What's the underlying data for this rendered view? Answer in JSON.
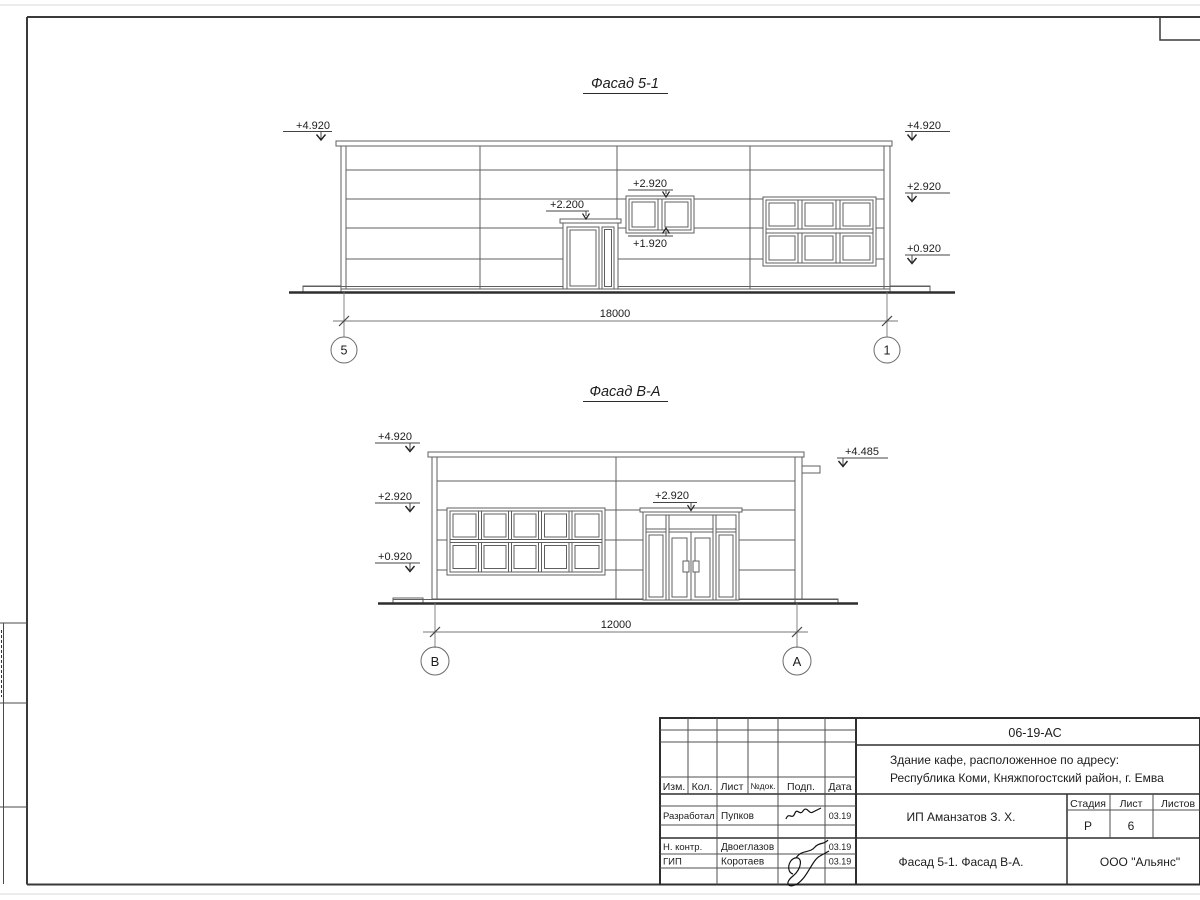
{
  "sheet": {
    "code_box": "06-19-АС"
  },
  "facade1": {
    "title": "Фасад 5-1",
    "marks": {
      "left_top": "+4.920",
      "right_top": "+4.920",
      "right_mid": "+2.920",
      "right_low": "+0.920",
      "door": "+2.200",
      "win_top": "+2.920",
      "win_sill": "+1.920"
    },
    "dim": "18000",
    "axis_left": "5",
    "axis_right": "1"
  },
  "facade2": {
    "title": "Фасад В-А",
    "marks": {
      "left_top": "+4.920",
      "left_mid": "+2.920",
      "left_low": "+0.920",
      "right_top": "+4.485",
      "entrance": "+2.920"
    },
    "dim": "12000",
    "axis_left": "В",
    "axis_right": "А"
  },
  "titleblock": {
    "code": "06-19-АС",
    "address_line1": "Здание кафе, расположенное по адресу:",
    "address_line2": "Республика Коми, Княжпогостский район, г. Емва",
    "client": "ИП Аманзатов З. Х.",
    "doc_title": "Фасад 5-1. Фасад В-А.",
    "company": "ООО \"Альянс\"",
    "headers": {
      "izm": "Изм.",
      "kol": "Кол.",
      "list": "Лист",
      "doc": "№док.",
      "podp": "Подп.",
      "data": "Дата"
    },
    "stage_label": "Стадия",
    "sheet_label": "Лист",
    "sheets_label": "Листов",
    "stage": "Р",
    "sheet_no": "6",
    "rows": [
      {
        "role": "Разработал",
        "name": "Пупков",
        "date": "03.19"
      },
      {
        "role": "Н. контр.",
        "name": "Двоеглазов",
        "date": "03.19"
      },
      {
        "role": "ГИП",
        "name": "Коротаев",
        "date": "03.19"
      }
    ]
  }
}
